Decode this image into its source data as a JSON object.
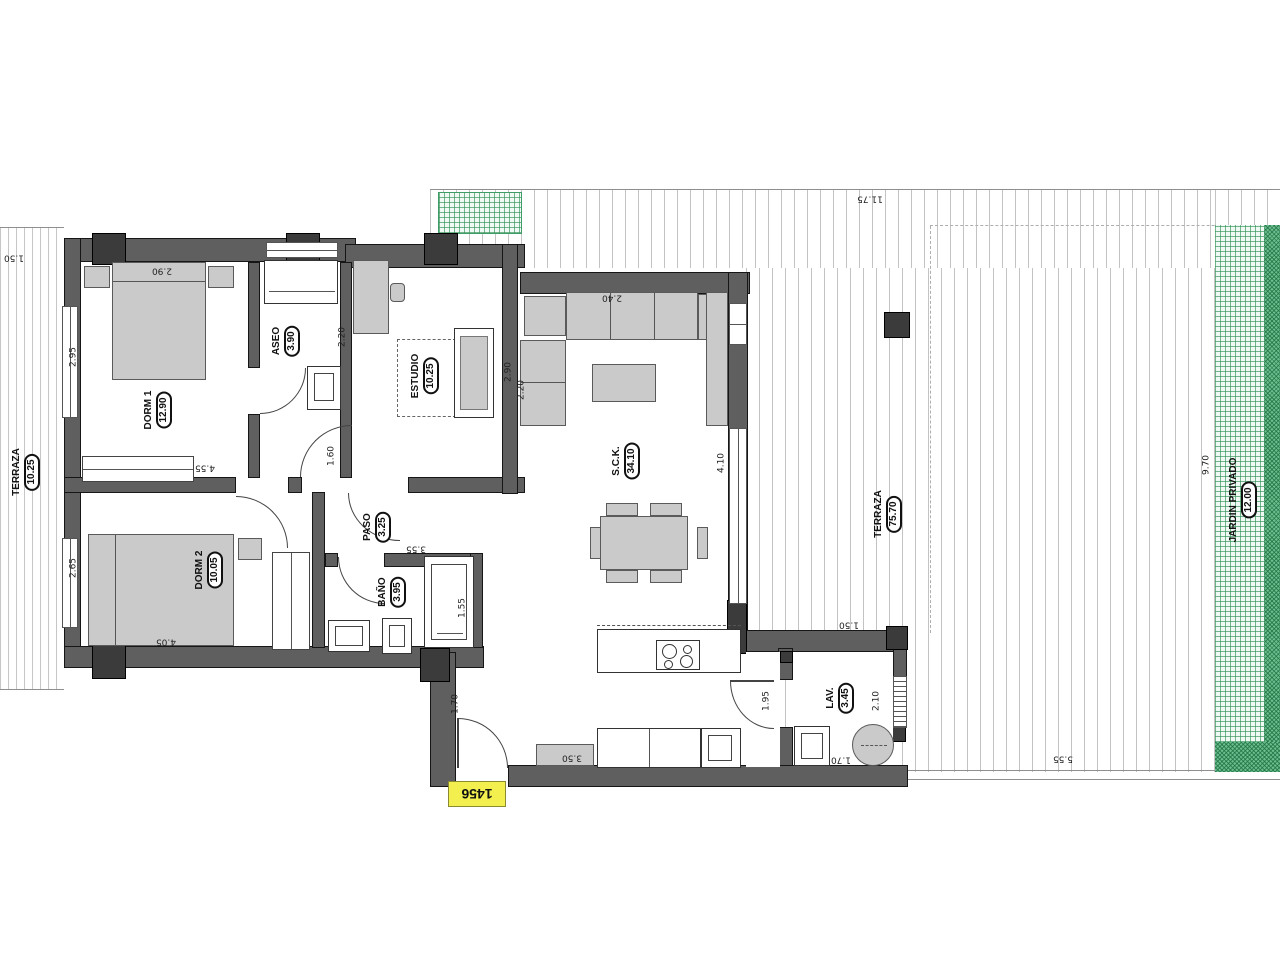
{
  "colors": {
    "wall": "#5f5f5f",
    "pillar": "#3b3b3b",
    "furniture": "#cacaca",
    "garden_green": "#2f9156",
    "hatch_gray": "#c3c3c3",
    "tag_yellow": "#f2ef4f"
  },
  "tag": {
    "ref": "1456"
  },
  "rooms": {
    "dorm1": {
      "name": "DORM 1",
      "area": "12.90"
    },
    "dorm2": {
      "name": "DORM 2",
      "area": "10.05"
    },
    "aseo": {
      "name": "ASEO",
      "area": "3.90"
    },
    "bano": {
      "name": "BAÑO",
      "area": "3.95"
    },
    "paso": {
      "name": "PASO",
      "area": "3.25"
    },
    "estudio": {
      "name": "ESTUDIO",
      "area": "10.25"
    },
    "sck": {
      "name": "S.C.K.",
      "area": "34.10"
    },
    "lav": {
      "name": "LAV.",
      "area": "3.45"
    },
    "terraza_left": {
      "name": "TERRAZA",
      "area": "10.25"
    },
    "terraza": {
      "name": "TERRAZA",
      "area": "75.70"
    },
    "jardin": {
      "name": "JARDIN PRIVADO",
      "area": "12.00"
    }
  },
  "dims": {
    "terraza_top_width": "11.75",
    "side_walk": "1.50",
    "dorm1_width": "2.90",
    "dorm1_depth": "2.95",
    "dorm1_closet": "4.55",
    "dorm2_depth": "2.65",
    "dorm2_width": "4.05",
    "paso_door": "1.60",
    "aseo_depth": "2.20",
    "bano_width": "3.55",
    "shower": "1.55",
    "sofa_width": "2.40",
    "sofa_depth": "2.20",
    "estudio_depth": "2.90",
    "sck_depth": "4.10",
    "lav_offset": "1.50",
    "lav_depth": "2.10",
    "lav_width": "1.70",
    "entry_door": "1.70",
    "terrace_door": "1.95",
    "kitchen_width": "3.50",
    "terraza_bottom": "5.55",
    "jardin_depth": "9.70"
  }
}
